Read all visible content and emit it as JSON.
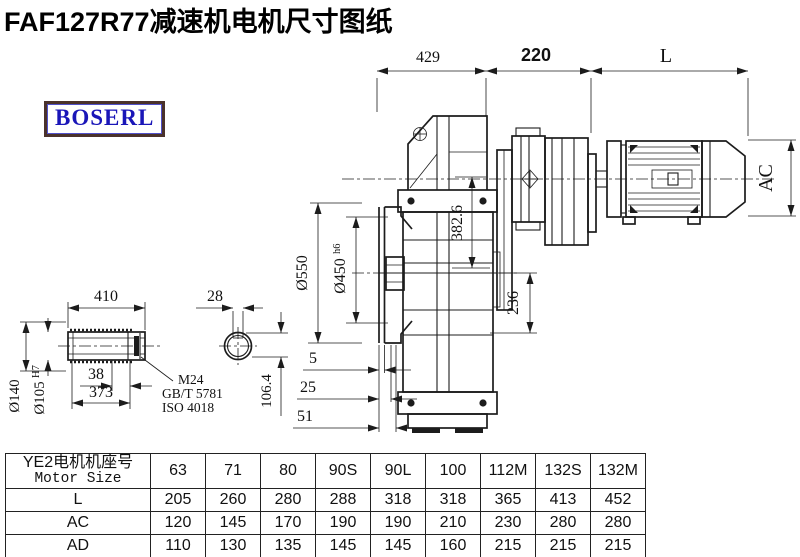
{
  "title": "FAF127R77减速机电机尺寸图纸",
  "brand": "BOSERL",
  "colors": {
    "line": "#1c1c1c",
    "brand_text": "#1a16b8",
    "brand_border": "#4a322b"
  },
  "drawing": {
    "dims": {
      "top_left": "429",
      "top_mid": "220",
      "top_right": "L",
      "motor_diameter": "AC",
      "flange_outer": "Ø550",
      "spigot_main": "Ø450",
      "spigot_tol": "h6",
      "center_height": "382.6",
      "axis_to_base": "236",
      "step1": "5",
      "step2": "25",
      "step3": "51",
      "shaft_length": "410",
      "shaft_collar": "Ø140",
      "bore_main": "Ø105",
      "bore_tol": "H7",
      "retainer_width": "38",
      "bolt_depth": "373",
      "keyway_width": "28",
      "bore_keyway_height": "106.4"
    },
    "leader": {
      "line1": "M24",
      "line2": "GB/T 5781",
      "line3": "ISO 4018"
    }
  },
  "table": {
    "header_zh": "YE2电机机座号",
    "header_en": "Motor Size",
    "columns": [
      "63",
      "71",
      "80",
      "90S",
      "90L",
      "100",
      "112M",
      "132S",
      "132M"
    ],
    "rows": [
      {
        "label": "L",
        "values": [
          "205",
          "260",
          "280",
          "288",
          "318",
          "318",
          "365",
          "413",
          "452"
        ]
      },
      {
        "label": "AC",
        "values": [
          "120",
          "145",
          "170",
          "190",
          "190",
          "210",
          "230",
          "280",
          "280"
        ]
      },
      {
        "label": "AD",
        "values": [
          "110",
          "130",
          "135",
          "145",
          "145",
          "160",
          "215",
          "215",
          "215"
        ]
      }
    ]
  }
}
